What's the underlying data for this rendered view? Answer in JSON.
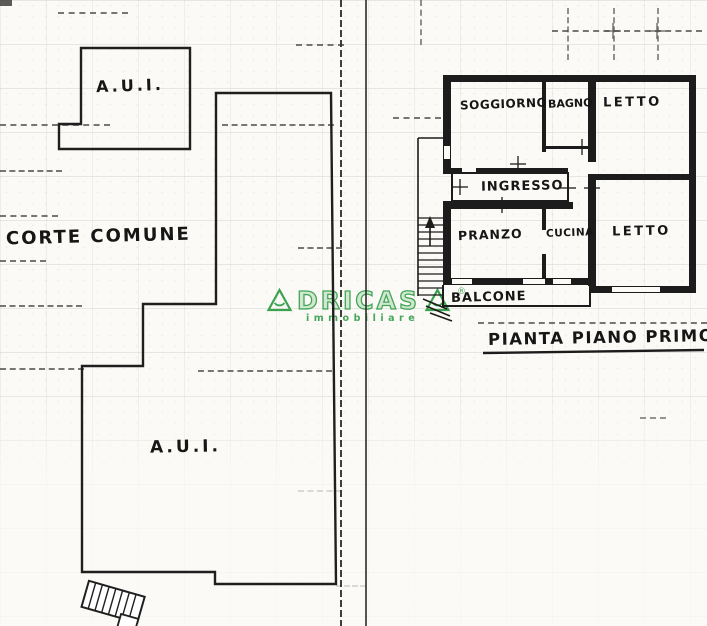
{
  "page": {
    "paper_color": "#fbfaf6",
    "ink_color": "#1f1f1f",
    "watermark_green": "#3ba24f"
  },
  "site_plan": {
    "upper_parcel_label": "A.U.I.",
    "courtyard_label": "CORTE COMUNE",
    "main_parcel_label": "A.U.I."
  },
  "floor_plan": {
    "title": "PIANTA PIANO PRIMO",
    "rooms": [
      {
        "name": "SOGGIORNO"
      },
      {
        "name": "BAGNO"
      },
      {
        "name": "LETTO"
      },
      {
        "name": "INGRESSO"
      },
      {
        "name": "PRANZO"
      },
      {
        "name": "CUCINA"
      },
      {
        "name": "LETTO"
      },
      {
        "name": "BALCONE"
      }
    ]
  },
  "watermark": {
    "brand": "ADRICASA",
    "brand_mid": "DRICAS",
    "tagline": "immobiliare",
    "registered": "®"
  }
}
